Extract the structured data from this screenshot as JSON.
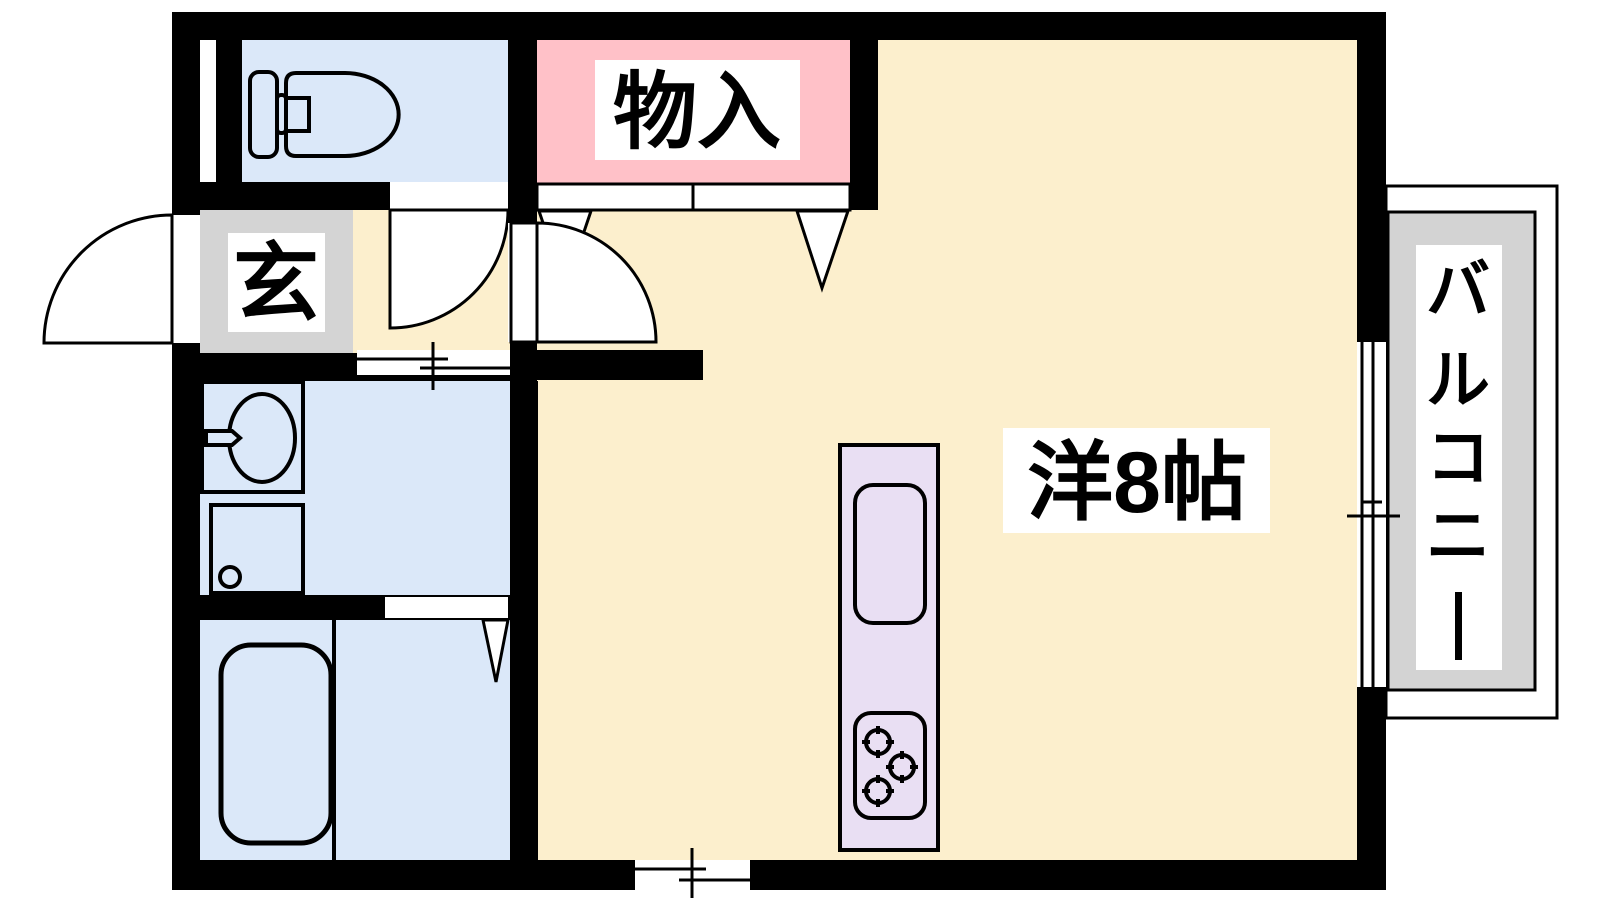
{
  "plan": {
    "background_color": "#FFFFFF",
    "wall_color": "#000000",
    "labels": {
      "storage": "物入",
      "entrance": "玄",
      "main_room": "洋8帖",
      "balcony": "バルコニー"
    },
    "balcony_chars": [
      "バ",
      "ル",
      "コ",
      "ニ",
      "ー"
    ],
    "room_colors": {
      "main_room": "#FCEFCD",
      "storage": "#FFC1C8",
      "entrance": "#D4D4D4",
      "toilet": "#DBE8F9",
      "washroom": "#DBE8F9",
      "bathroom": "#DBE8F9",
      "kitchen_counter": "#E9DFF3",
      "balcony": "#D3D3D3"
    },
    "icons": {
      "toilet": "toilet-icon",
      "wash_basin": "wash-basin-icon",
      "washing_machine": "washing-machine-icon",
      "bathtub": "bathtub-icon",
      "kitchen_sink": "kitchen-sink-icon",
      "gas_stove": "gas-stove-icon",
      "hinged_door": "door-swing-arc-icon",
      "folding_door": "folding-door-v-icon",
      "sliding_door": "sliding-door-icon",
      "window": "window-icon"
    }
  }
}
